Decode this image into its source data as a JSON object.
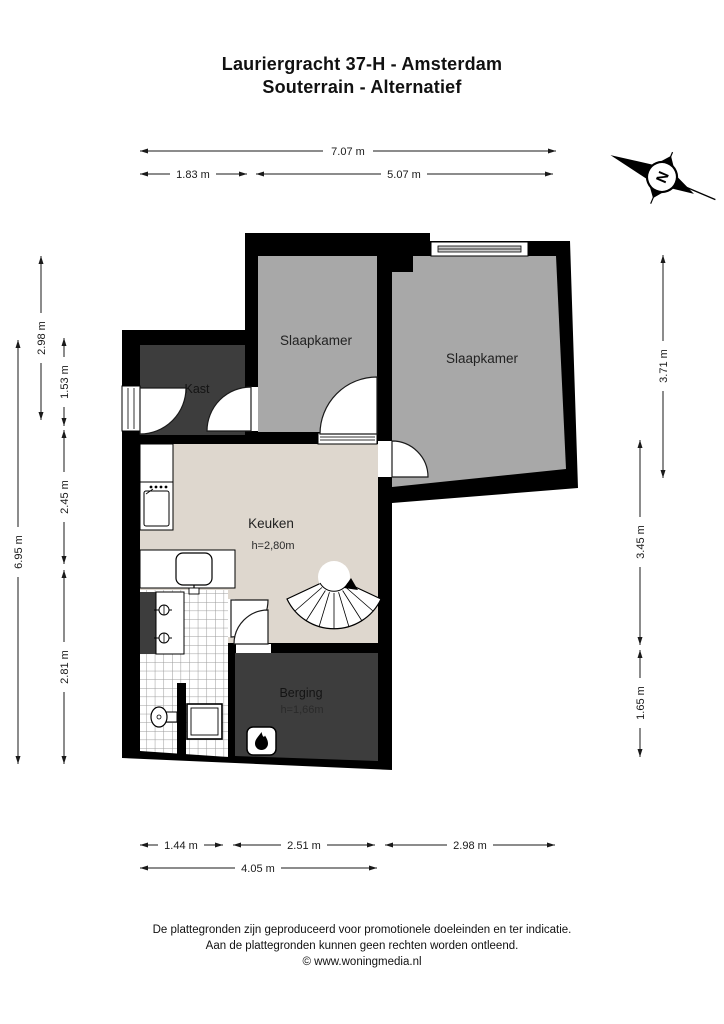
{
  "title": {
    "line1": "Lauriergracht 37-H - Amsterdam",
    "line2": "Souterrain - Alternatief"
  },
  "compass": {
    "north_label": "N"
  },
  "rooms": {
    "slaapkamer_left": {
      "name": "Slaapkamer"
    },
    "slaapkamer_right": {
      "name": "Slaapkamer"
    },
    "kast": {
      "name": "Kast"
    },
    "keuken": {
      "name": "Keuken",
      "ceiling_height": "h=2,80m"
    },
    "berging": {
      "name": "Berging",
      "ceiling_height": "h=1,66m"
    }
  },
  "dimensions": {
    "top": [
      {
        "label": "7.07 m"
      },
      {
        "label": "1.83 m"
      },
      {
        "label": "5.07 m"
      }
    ],
    "left": [
      {
        "label": "6.95 m"
      },
      {
        "label": "2.98 m"
      },
      {
        "label": "1.53 m"
      },
      {
        "label": "2.45 m"
      },
      {
        "label": "2.81 m"
      }
    ],
    "right": [
      {
        "label": "3.71 m"
      },
      {
        "label": "3.45 m"
      },
      {
        "label": "1.65 m"
      }
    ],
    "bottom": [
      {
        "label": "1.44 m"
      },
      {
        "label": "2.51 m"
      },
      {
        "label": "2.98 m"
      },
      {
        "label": "4.05 m"
      }
    ]
  },
  "footer": {
    "line1": "De plattegronden zijn geproduceerd voor promotionele doeleinden en ter indicatie.",
    "line2": "Aan de plattegronden kunnen geen rechten worden ontleend.",
    "line3": "© www.woningmedia.nl"
  },
  "colors": {
    "wall": "#000000",
    "room_light": "#a8a8a8",
    "room_dark": "#3d3d3d",
    "floor_light": "#ded7ce",
    "window_glass": "#c9c9c9"
  }
}
